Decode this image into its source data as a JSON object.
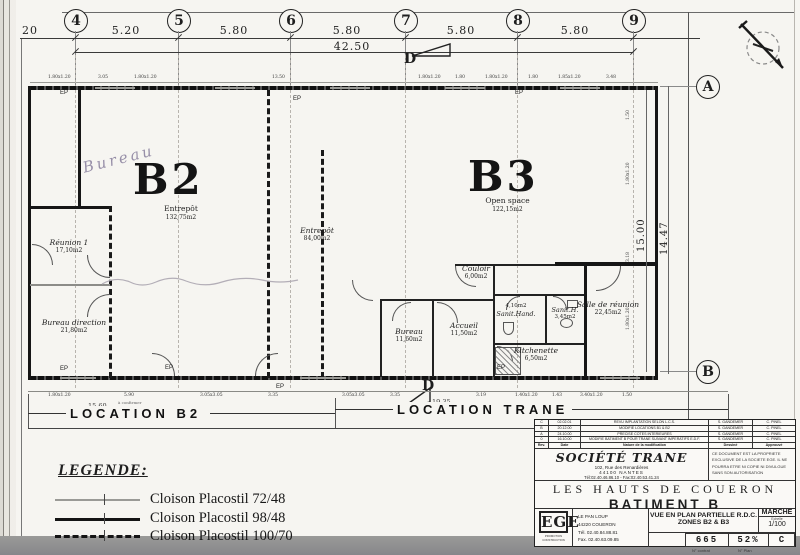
{
  "grid": {
    "cols": [
      {
        "label": "4"
      },
      {
        "label": "5"
      },
      {
        "label": "6"
      },
      {
        "label": "7"
      },
      {
        "label": "8"
      },
      {
        "label": "9"
      }
    ],
    "rows": [
      {
        "label": "A"
      },
      {
        "label": "B"
      }
    ],
    "top_dims": [
      "20",
      "5.20",
      "5.80",
      "5.80",
      "5.80",
      "5.80"
    ],
    "overall": "42.50",
    "side_dims": [
      "15.00",
      "14.47"
    ]
  },
  "window_dims_top": [
    "1.80x1.20",
    "3.05",
    "1.80x1.20",
    "13.50",
    "1.80x1.20",
    "1.80",
    "1.80x1.20",
    "1.80",
    "1.85x1.20",
    "3.48"
  ],
  "window_dims_bottom": [
    "1.80x1.20",
    "5.90",
    "3.05x3.05",
    "3.35",
    "3.05x3.05",
    "3.35",
    "3.19",
    "1.40x1.20",
    "1.43",
    "3.40x1.20",
    "1.50"
  ],
  "side_window_dims": [
    "1.50",
    "1.80x1.20",
    "3.18",
    "1.80x1.20"
  ],
  "plan": {
    "zones": [
      {
        "code": "B2",
        "type": "Entrepôt",
        "area": "132,75m2"
      },
      {
        "code": "B3",
        "type": "Open space",
        "area": "122,15m2"
      }
    ],
    "rooms": [
      {
        "name": "Réunion 1",
        "area": "17,10m2"
      },
      {
        "name": "Bureau direction",
        "area": "21,80m2"
      },
      {
        "name": "Entrepôt",
        "area": "84,00m2"
      },
      {
        "name": "Couloir",
        "area": "6,00m2"
      },
      {
        "name": "Bureau",
        "area": "11,60m2"
      },
      {
        "name": "Accueil",
        "area": "11,50m2"
      },
      {
        "name": "Sanit.Hand.",
        "area": "4,10m2"
      },
      {
        "name": "Sanit.H.",
        "area": "3,45m2"
      },
      {
        "name": "Salle de réunion",
        "area": "22,45m2"
      },
      {
        "name": "Kitchenette",
        "area": "6,50m2"
      }
    ],
    "handwriting": "Bureau",
    "ep_label": "EP",
    "section_marker": "D"
  },
  "locations": {
    "b2": {
      "label": "LOCATION B2",
      "dim": "15,60",
      "note": "à confirmer"
    },
    "trane": {
      "label": "LOCATION TRANE",
      "dim": "19,35"
    }
  },
  "legend": {
    "title": "LEGENDE:",
    "items": [
      {
        "label": "Cloison Placostil 72/48"
      },
      {
        "label": "Cloison Placostil 98/48"
      },
      {
        "label": "Cloison Placostil 100/70"
      }
    ]
  },
  "titleblock": {
    "revisions": [
      {
        "rev": "C",
        "date": "02.02.01",
        "nature": "REVU IMPLANTATION SELON L.C.S.",
        "drawn": "S. GANDEMER",
        "approved": "C. PINEL"
      },
      {
        "rev": "B",
        "date": "20.12.00",
        "nature": "MODIFIE LOCATIONS B1 & B2",
        "drawn": "S. GANDEMER",
        "approved": "C. PINEL"
      },
      {
        "rev": "A",
        "date": "24.10.00",
        "nature": "PRECISE COTES INTERIEURES",
        "drawn": "S. GANDEMER",
        "approved": "C. PINEL"
      },
      {
        "rev": "0",
        "date": "16.10.00",
        "nature": "MODIFIE BATIMENT B POUR TRANE SUIVANT IMPERATIFS E.D.F.",
        "drawn": "S. GANDEMER",
        "approved": "C. PINEL"
      }
    ],
    "rev_header": {
      "rev": "Rev.",
      "date": "Date",
      "nature": "Nature de la modification",
      "drawn": "Dessiné",
      "approved": "Approuvé"
    },
    "company": {
      "name": "SOCIÉTÉ TRANE",
      "address1": "102, Rue des Renardières",
      "address2": "44100 NANTES",
      "phone": "Tél:02.40.46.86.10 - Fax:02.40.53.41.24"
    },
    "disclaimer": "CE DOCUMENT EST LA PROPRIETE EXCLUSIVE DE LA SOCIETE EGE. IL NE POURRA ETRE NI COPIE NI DIVULGUE SANS SON AUTORISATION",
    "project": "LES HAUTS DE COUERON",
    "building": "BATIMENT B",
    "firm": {
      "logo": "EGE",
      "sub": "PROMOTION CONSTRUCTION",
      "address1": "LE PAN LOUP",
      "address2": "44220 COUERON",
      "phone": "Tél. 02.40.84.88.81",
      "fax": "Fax. 02.40.63.09.85"
    },
    "view": {
      "line1": "VUE EN PLAN PARTIELLE R.D.C.",
      "line2": "ZONES B2 & B3"
    },
    "marche": {
      "label": "MARCHE",
      "scale_label": "Echelle",
      "scale": "1/100"
    },
    "numbers": {
      "contract": "665",
      "plan": "52%",
      "rev": "C",
      "contract_label": "N° contrat",
      "plan_label": "N° Plan"
    }
  }
}
